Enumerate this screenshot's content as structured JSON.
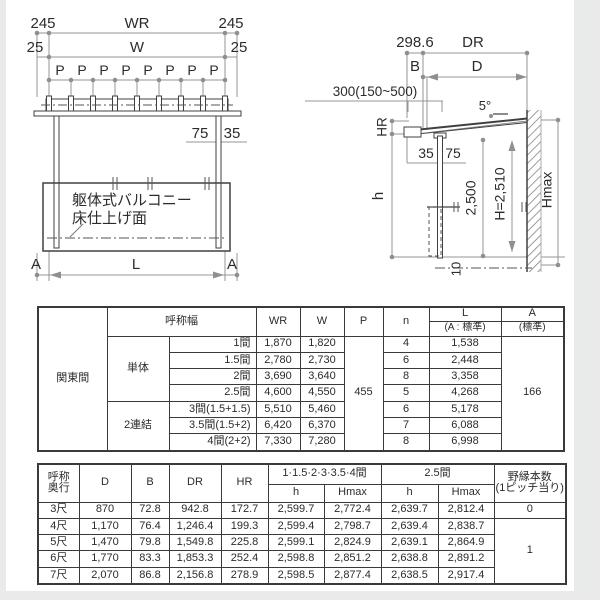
{
  "front_view": {
    "dim_245_left": "245",
    "dim_wr": "WR",
    "dim_245_right": "245",
    "dim_25_left": "25",
    "dim_w": "W",
    "dim_25_right": "25",
    "p_labels": [
      "P",
      "P",
      "P",
      "P",
      "P",
      "P",
      "P",
      "P"
    ],
    "dim_75": "75",
    "dim_35": "35",
    "balcony_line1": "躯体式バルコニー",
    "balcony_line2": "床仕上げ面",
    "dim_a_left": "A",
    "dim_l": "L",
    "dim_a_right": "A"
  },
  "side_view": {
    "dim_298_6": "298.6",
    "dim_dr": "DR",
    "dim_b": "B",
    "dim_d": "D",
    "dim_300": "300(150~500)",
    "dim_5deg": "5°",
    "dim_hr": "HR",
    "dim_35": "35",
    "dim_75": "75",
    "dim_h": "h",
    "dim_2500": "2,500",
    "dim_h2510": "H=2,510",
    "dim_hmax": "Hmax",
    "dim_10": "10"
  },
  "kanto": {
    "region": "関東間",
    "header": {
      "width_label": "呼称幅",
      "wr": "WR",
      "w": "W",
      "p": "P",
      "n": "n",
      "l": "L",
      "l_sub": "(A : 標準)",
      "a": "A",
      "a_sub": "(標準)"
    },
    "group_single": "単体",
    "group_double": "2連結",
    "p_value": "455",
    "a_value": "166",
    "rows": [
      {
        "size": "1間",
        "wr": "1,870",
        "w": "1,820",
        "n": "4",
        "l": "1,538"
      },
      {
        "size": "1.5間",
        "wr": "2,780",
        "w": "2,730",
        "n": "6",
        "l": "2,448"
      },
      {
        "size": "2間",
        "wr": "3,690",
        "w": "3,640",
        "n": "8",
        "l": "3,358"
      },
      {
        "size": "2.5間",
        "wr": "4,600",
        "w": "4,550",
        "n": "5",
        "l": "4,268"
      },
      {
        "size": "3間(1.5+1.5)",
        "wr": "5,510",
        "w": "5,460",
        "n": "6",
        "l": "5,178"
      },
      {
        "size": "3.5間(1.5+2)",
        "wr": "6,420",
        "w": "6,370",
        "n": "7",
        "l": "6,088"
      },
      {
        "size": "4間(2+2)",
        "wr": "7,330",
        "w": "7,280",
        "n": "8",
        "l": "6,998"
      }
    ]
  },
  "depth": {
    "header": {
      "name_l1": "呼称",
      "name_l2": "奥行",
      "d": "D",
      "b": "B",
      "dr": "DR",
      "hr": "HR",
      "group1": "1·1.5·2·3·3.5·4間",
      "group2": "2.5間",
      "h": "h",
      "hmax": "Hmax",
      "joist_l1": "野縁本数",
      "joist_l2": "(1ピッチ当り)"
    },
    "joist_first": "0",
    "joist_rest": "1",
    "rows": [
      {
        "name": "3尺",
        "d": "870",
        "b": "72.8",
        "dr": "942.8",
        "hr": "172.7",
        "h1": "2,599.7",
        "hmax1": "2,772.4",
        "h2": "2,639.7",
        "hmax2": "2,812.4"
      },
      {
        "name": "4尺",
        "d": "1,170",
        "b": "76.4",
        "dr": "1,246.4",
        "hr": "199.3",
        "h1": "2,599.4",
        "hmax1": "2,798.7",
        "h2": "2,639.4",
        "hmax2": "2,838.7"
      },
      {
        "name": "5尺",
        "d": "1,470",
        "b": "79.8",
        "dr": "1,549.8",
        "hr": "225.8",
        "h1": "2,599.1",
        "hmax1": "2,824.9",
        "h2": "2,639.1",
        "hmax2": "2,864.9"
      },
      {
        "name": "6尺",
        "d": "1,770",
        "b": "83.3",
        "dr": "1,853.3",
        "hr": "252.4",
        "h1": "2,598.8",
        "hmax1": "2,851.2",
        "h2": "2,638.8",
        "hmax2": "2,891.2"
      },
      {
        "name": "7尺",
        "d": "2,070",
        "b": "86.8",
        "dr": "2,156.8",
        "hr": "278.9",
        "h1": "2,598.5",
        "hmax1": "2,877.4",
        "h2": "2,638.5",
        "hmax2": "2,917.4"
      }
    ]
  },
  "colors": {
    "dim_line": "#959595",
    "structure_line": "#404040",
    "text": "#2b2b2b",
    "table_border": "#3a3a3a",
    "page_edge": "#e9eaea"
  }
}
